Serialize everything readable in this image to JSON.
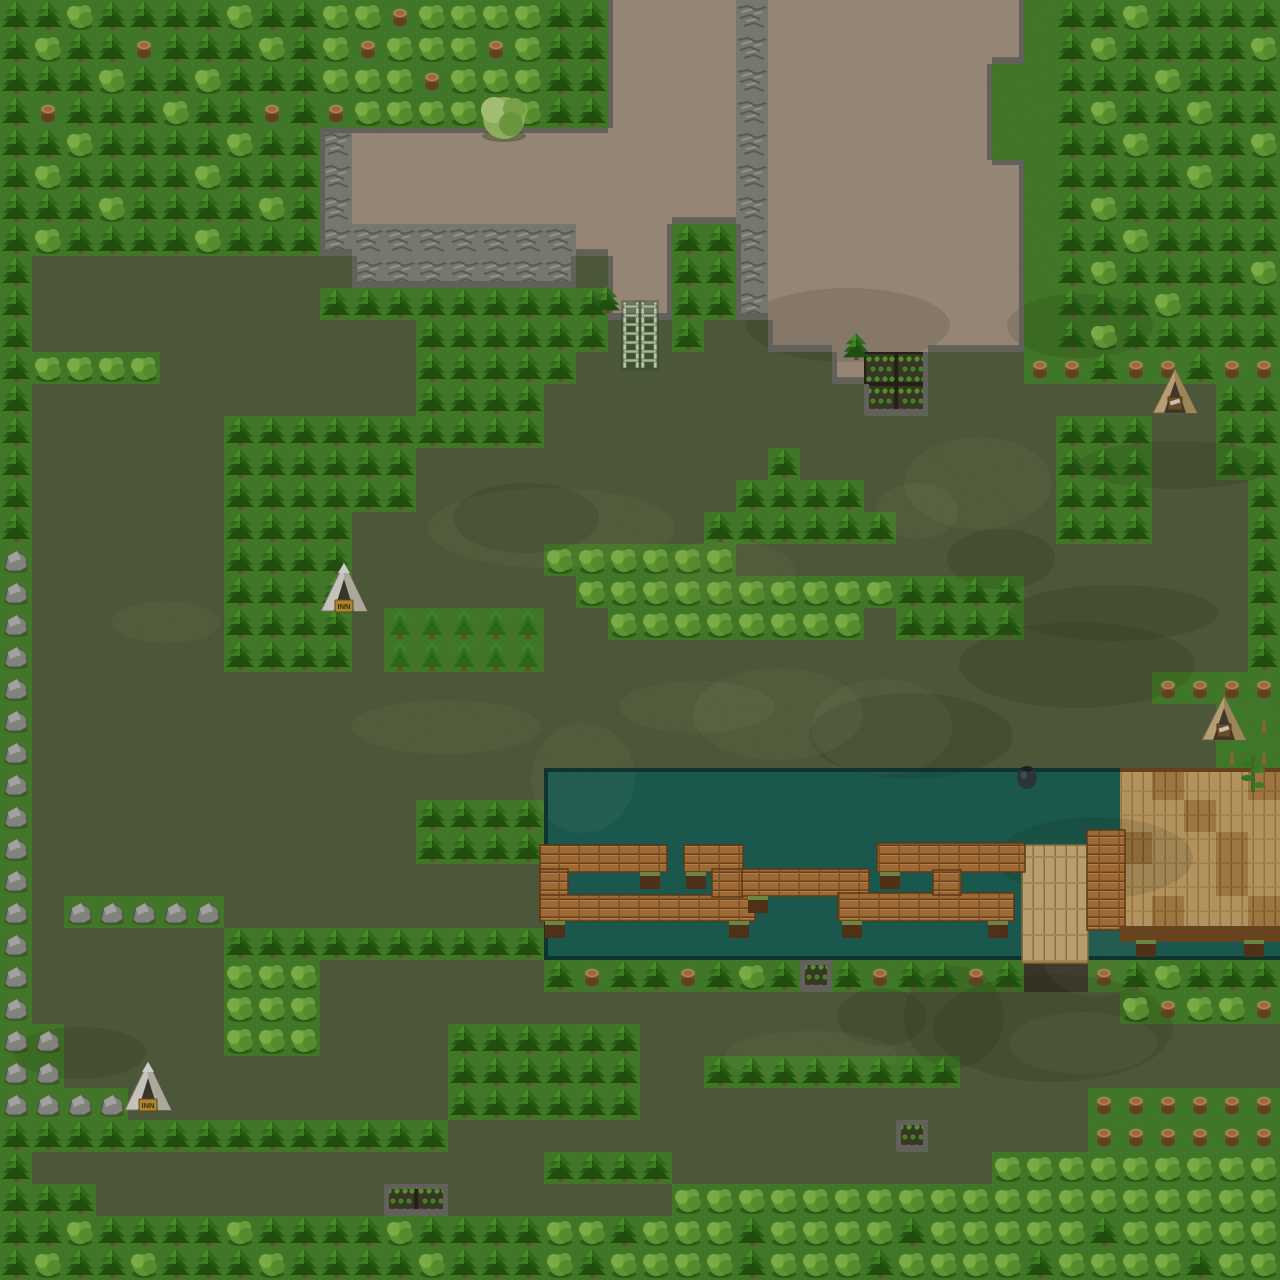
{
  "meta": {
    "tile_size": 32,
    "grid_w": 40,
    "grid_h": 40
  },
  "palette": {
    "bright": "#4e8d2f",
    "dark": "#5b6844",
    "dirt": "#b3a08c",
    "cliff": "#8f8f87",
    "water": "#20695d",
    "soil": "#45402f",
    "deckL": "#d6b072",
    "deckK": "#bd8d4e",
    "cliffEdge": "#75756b",
    "waterEdge": "#123f38",
    "deckEdge": "#7a4e24",
    "wood": "#bd7f41",
    "woodDark": "#6e441c"
  },
  "legend": {
    ".": "grass-bright",
    ",": "grass-dark",
    "d": "dirt-path",
    "c": "cliff-rock",
    "w": "water",
    "D": "deck-light-wood",
    "K": "deck-dark-wood",
    "T": "pine-tree",
    "t": "small-pine",
    "B": "round-bush",
    "s": "tree-stump",
    "r": "boulder",
    "p": "palm-tree",
    "g": "garden-plot",
    "z": "dark-soil"
  },
  "grid": [
    "TTBTTTTBTTBBsBBBBTTddddcdddddddd.TTBTTTT",
    "TBTTsTTTBTBsBBBsBTTddddcdddddddd.TBTTTTB",
    "TTTBTTBTTTBBBsBBBTTddddcddddddd..TTTBTTT",
    "TsTTTBTTsTsBBBBBBTTddddcddddddd..TBTTBTT",
    "TTBTTTTBTTcddddddddddddcddddddd..TTBTTTB",
    "TBTTTTBTTTcddddddddddddcdddddddd.TTTTBTT",
    "TTTBTTTTBTcddddddddddddcdddddddd.TBTTTTT",
    "TBTTTTBTTTccccccccdddTTcdddddddd.TTBTTTT",
    "T,,,,,,,,,,ccccccc,ddTTcdddddddd.TBTTTTB",
    "T,,,,,,,,,TTTTTTTTTddTTcdddddddd.TTTBTTT",
    "T,,,,,,,,,,,,TTTTTT,,T,,dddddddd.TBTTTTT",
    "TBBBB,,,,,,,,TTTTT,,,,,,,,dgg,,,ssTssTss",
    "T,,,,,,,,,,,,TTTT,,,,,,,,,,gg,,,,,,,,,TT",
    "T,,,,,,TTTTTTTTTT,,,,,,,,,,,,,,,,TTT,,TT",
    "T,,,,,,TTTTTT,,,,,,,,,,,T,,,,,,,,TTT,,TT",
    "T,,,,,,TTTTTT,,,,,,,,,,TTTT,,,,,,TTT,,,T",
    "T,,,,,,TTTT,,,,,,,,,,,TTTTTT,,,,,TTT,,,T",
    "r,,,,,,TTTT,,,,,,BBBBBB,,,,,,,,,,,,,,,,T",
    "r,,,,,,TTTT,,,,,,,BBBBBBBBBBTTTT,,,,,,,T",
    "r,,,,,,TTTT,ttttt,,BBBBBBBB,TTTT,,,,,,,T",
    "r,,,,,,TTTT,ttttt,,,,,,,,,,,,,,,,,,,,,,T",
    "r,,,,,,,,,,,,,,,,,,,,,,,,,,,,,,,,,,,ssss",
    "r,,,,,,,,,,,,,,,,,,,,,,,,,,,,,,,,,,,,,pp",
    "r,,,,,,,,,,,,,,,,,,,,,,,,,,,,,,,,,,,,,pp",
    "r,,,,,,,,,,,,,,,,wwwwwwwwwwwwwwwwwwDKDDK",
    "r,,,,,,,,,,,,TTTTwwwwwwwwwwwwwwwwwwDDKDD",
    "r,,,,,,,,,,,,TTTTwwwwwwwwwwwwwwwwwwKDDKD",
    "r,,,,,,,,,,,,,,,,wwwwwwwwwwwwwwwwwwDDDKD",
    "r,rrrrr,,,,,,,,,,wwwwwwwwwwwwwwwwwwDKDDK",
    "r,,,,,,TTTTTTTTTTwwwwwwwwwwwwwwwwwwwwwww",
    "r,,,,,,BBB,,,,,,,TsTTsTBTgTsTTsTzzsTBTTT",
    "r,,,,,,BBB,,,,,,,,,,,,,,,,,,,,,,,,,BsBBs",
    "rr,,,,,BBB,,,,TTTTTT,,,,,,,,,,,,,,,,,,,,",
    "rr,,,,,,,,,,,,TTTTTT,,TTTTTTTT,,,,,,,,,,",
    "rrrr,,,,,,,,,,TTTTTT,,,,,,,,,,,,,,ssssss",
    "TTTTTTTTTTTTTT,,,,,,,,,,,,,,g,,,,,ssssss",
    "T,,,,,,,,,,,,,,,,TTTT,,,,,,,,,,BBBBBBBBB",
    "TTT,,,,,,,,,gg,,,,,,,BBBBBBBBBBBBBBBBBBB",
    "TTBTTTTBTTTTBTTTTBBTBBBTBBBBTBBBBBTBBBBB",
    "TBTTBTTTBTTTTBTTTBTBBBBTBBBTBBBBTBBBBTBB"
  ],
  "boardwalk": {
    "bars": [
      {
        "x": 540,
        "y": 845,
        "w": 127,
        "h": 27
      },
      {
        "x": 540,
        "y": 869,
        "w": 28,
        "h": 52
      },
      {
        "x": 540,
        "y": 895,
        "w": 215,
        "h": 26
      },
      {
        "x": 684,
        "y": 845,
        "w": 59,
        "h": 27
      },
      {
        "x": 712,
        "y": 869,
        "w": 31,
        "h": 28
      },
      {
        "x": 742,
        "y": 869,
        "w": 127,
        "h": 27
      },
      {
        "x": 838,
        "y": 893,
        "w": 176,
        "h": 28
      },
      {
        "x": 877,
        "y": 843,
        "w": 148,
        "h": 29
      },
      {
        "x": 933,
        "y": 870,
        "w": 28,
        "h": 25
      },
      {
        "x": 1087,
        "y": 830,
        "w": 38,
        "h": 100
      }
    ],
    "supports": [
      [
        545,
        921
      ],
      [
        640,
        872
      ],
      [
        686,
        872
      ],
      [
        729,
        921
      ],
      [
        748,
        896
      ],
      [
        842,
        921
      ],
      [
        988,
        921
      ],
      [
        880,
        872
      ],
      [
        1136,
        940
      ],
      [
        1244,
        940
      ]
    ],
    "pier": {
      "x": 1022,
      "y": 845,
      "w": 66,
      "h": 118
    },
    "deck_face": {
      "x": 1120,
      "y": 926,
      "w": 160,
      "h": 16
    }
  },
  "objects": [
    {
      "type": "tent-white",
      "label": "INN",
      "x": 320,
      "y": 561
    },
    {
      "type": "tent-white",
      "label": "INN",
      "x": 124,
      "y": 1060
    },
    {
      "type": "tent-beige",
      "x": 1152,
      "y": 367
    },
    {
      "type": "tent-beige",
      "x": 1201,
      "y": 694
    },
    {
      "type": "ladder",
      "x": 623,
      "y": 302
    },
    {
      "type": "ladder",
      "x": 641,
      "y": 302
    },
    {
      "type": "pot",
      "x": 1016,
      "y": 762
    },
    {
      "type": "vine",
      "x": 1243,
      "y": 756
    },
    {
      "type": "lone-pine",
      "x": 592,
      "y": 283
    },
    {
      "type": "lone-pine",
      "x": 841,
      "y": 330
    },
    {
      "type": "leafy-tree",
      "x": 478,
      "y": 90
    }
  ]
}
